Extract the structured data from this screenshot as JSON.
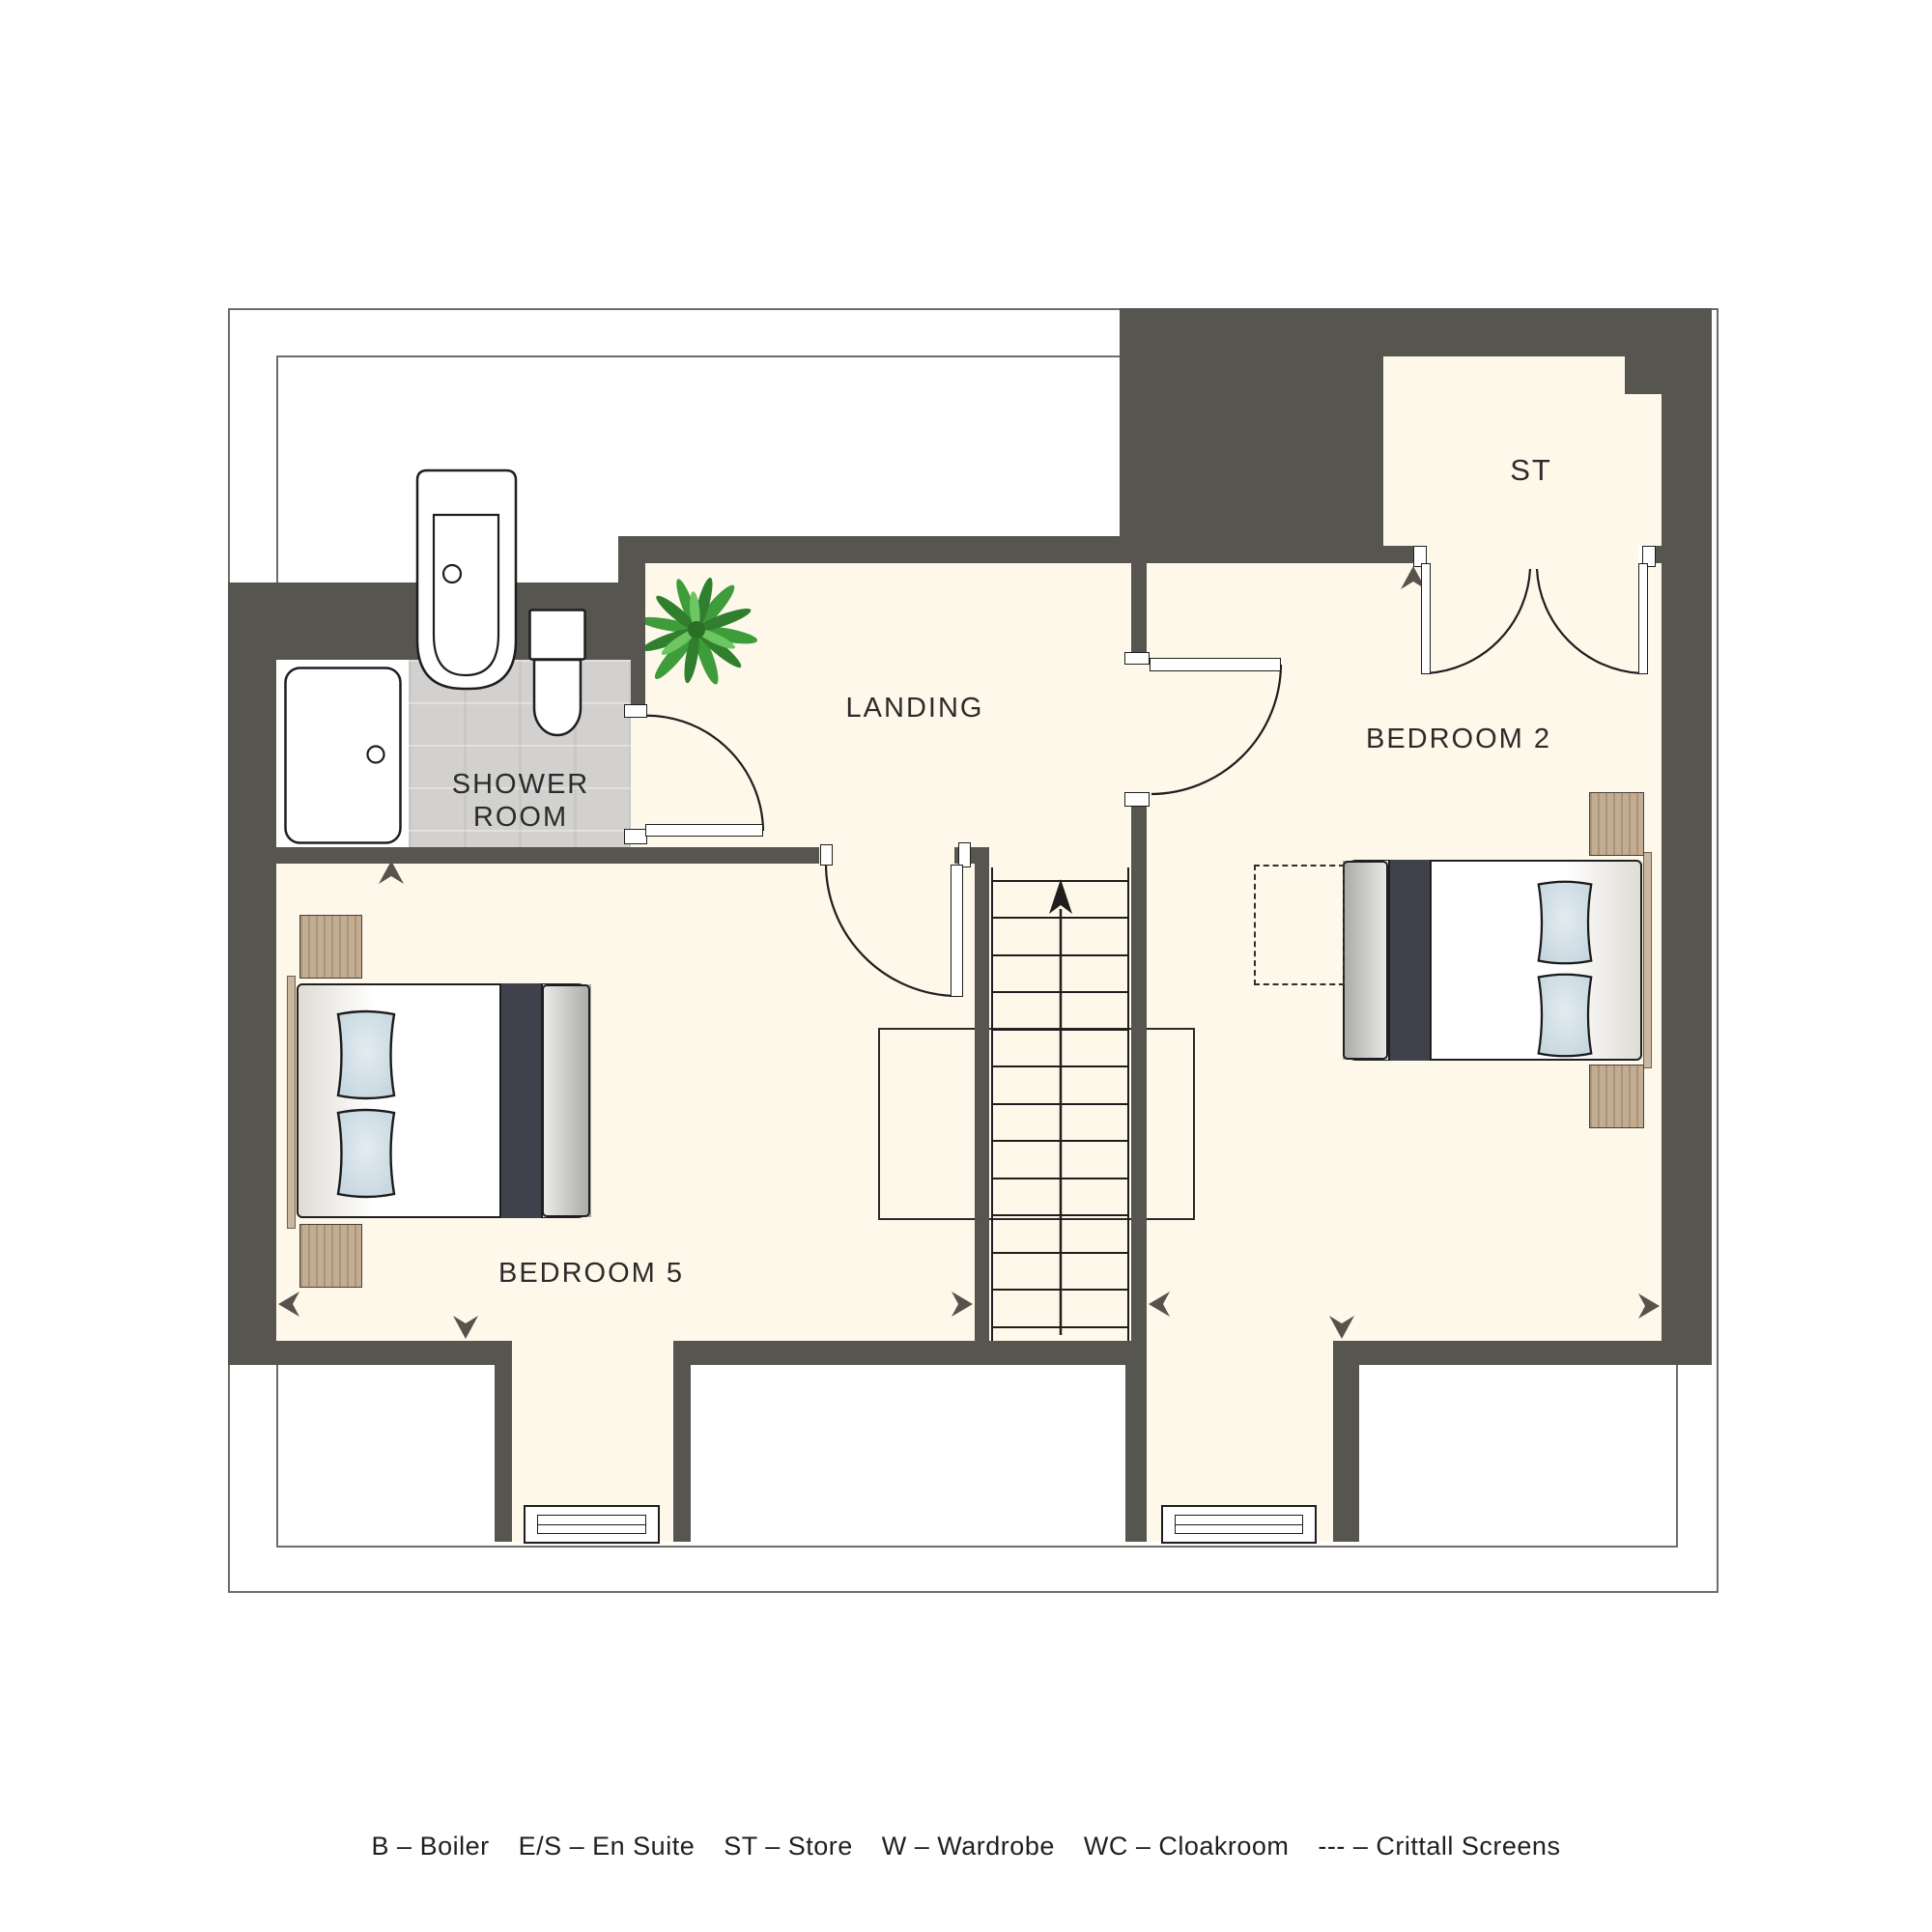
{
  "plan": {
    "type": "floor-plan",
    "floor_name": "attic floor",
    "rooms": [
      {
        "id": "landing",
        "label": "LANDING"
      },
      {
        "id": "shower_room",
        "label_line1": "SHOWER",
        "label_line2": "ROOM"
      },
      {
        "id": "bedroom_2",
        "label": "BEDROOM 2"
      },
      {
        "id": "bedroom_5",
        "label": "BEDROOM 5"
      },
      {
        "id": "store",
        "label": "ST"
      }
    ]
  },
  "labels": {
    "landing": "LANDING",
    "shower_line1": "SHOWER",
    "shower_line2": "ROOM",
    "bedroom2": "BEDROOM 2",
    "bedroom5": "BEDROOM 5",
    "store": "ST"
  },
  "legend": {
    "items": [
      "B – Boiler",
      "E/S – En Suite",
      "ST – Store",
      "W – Wardrobe",
      "WC – Cloakroom",
      "--- – Crittall Screens"
    ]
  },
  "colors": {
    "wall": "#575550",
    "floor": "#FDF8EA",
    "shower_floor": "#D2D1CF",
    "pillow": "#CEDDE5",
    "wood": "#C2AD92",
    "bed_runner": "#3F424D",
    "outline": "#6F6D68",
    "arrow": "#55534C",
    "label_text": "#2B2B2B"
  }
}
